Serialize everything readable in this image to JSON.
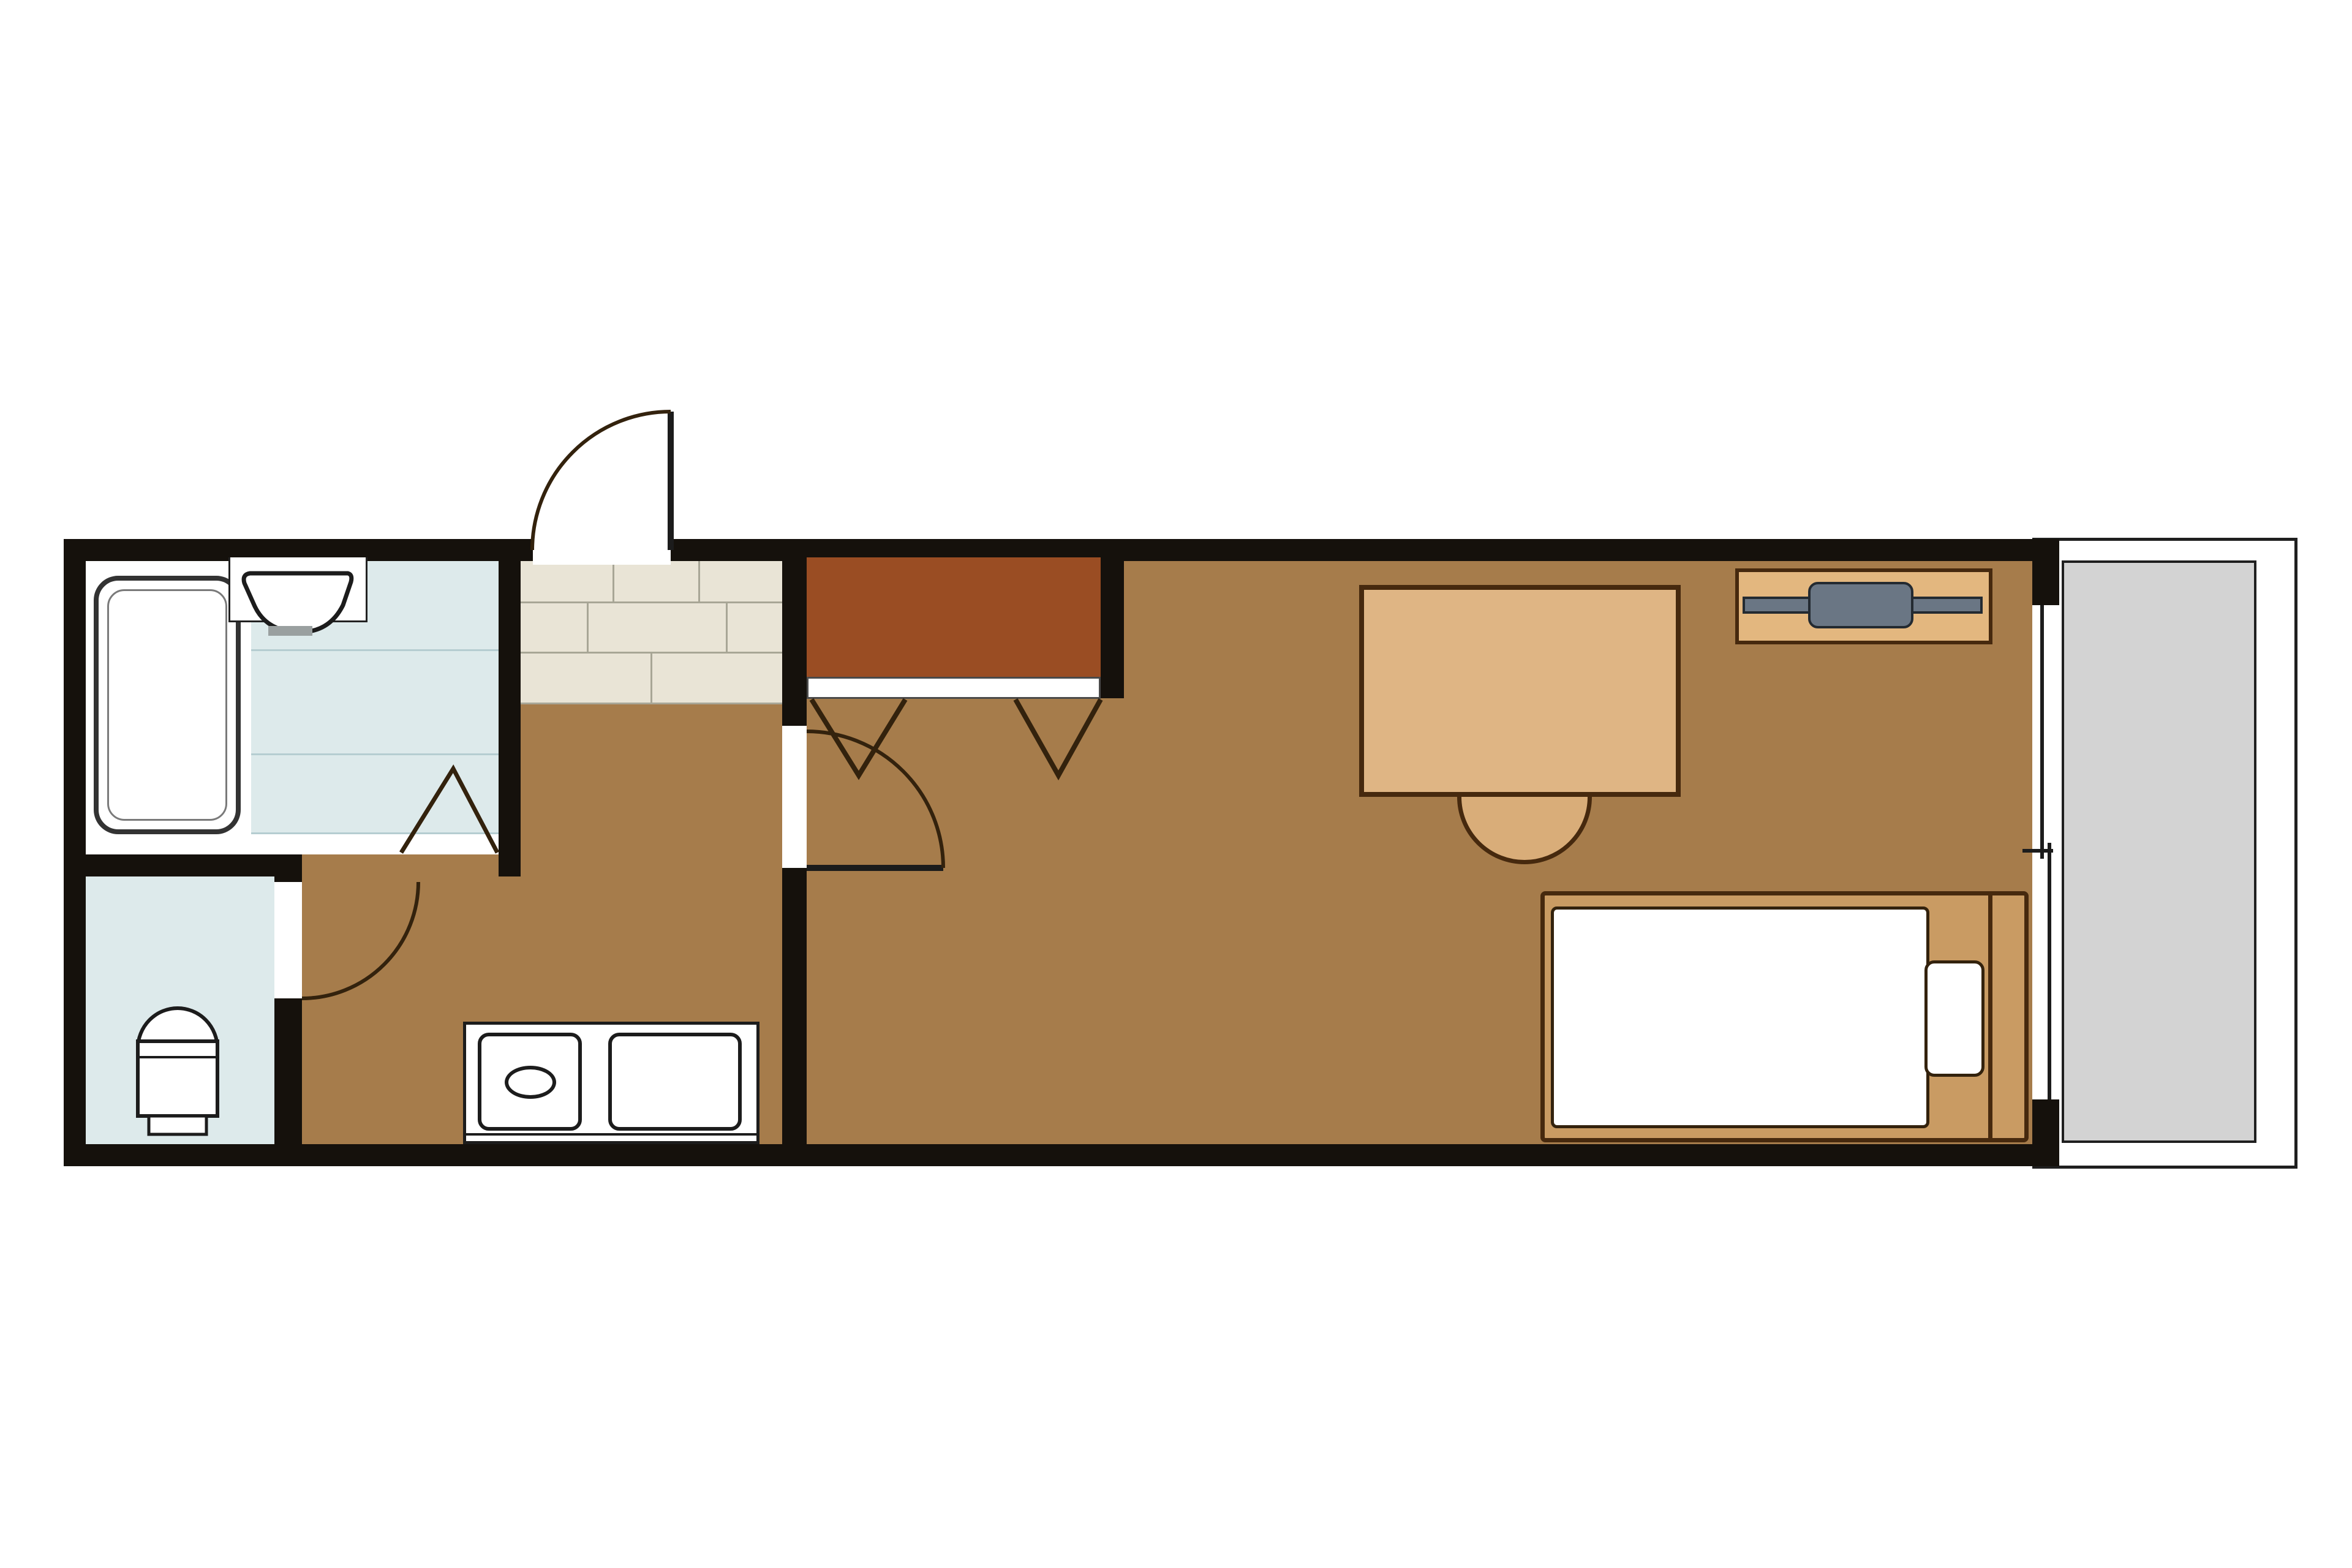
{
  "title": "one-room-apartment-floor-plan",
  "palette": {
    "bg": "#ffffff",
    "wall": "#15110c",
    "floor": "#a67c4b",
    "closet": "#9a4d23",
    "tile": "#ddeaeb",
    "tileLine": "#b5cdd1",
    "genkan": "#e9e4d6",
    "genkanLine": "#a8a696",
    "desk": "#dfb584",
    "chair": "#d9ad79",
    "stand": "#e3b77f",
    "bedframe": "#c99b63",
    "tv": "#6a7684",
    "balcony": "#d3d3d3",
    "outline": "#46290e",
    "symbol": "#33220d",
    "fixture": "#1c1c1c"
  },
  "rooms": [
    {
      "id": "bathroom",
      "floor": "tile-blue",
      "fixtures": [
        "bathtub",
        "washbasin",
        "folding-door"
      ]
    },
    {
      "id": "toilet-room",
      "floor": "tile-blue",
      "fixtures": [
        "toilet",
        "swing-door"
      ]
    },
    {
      "id": "hallway-kitchen",
      "floor": "wood-brown",
      "fixtures": [
        "kitchen-counter",
        "burner",
        "sink",
        "entrance-door",
        "genkan-tiles"
      ]
    },
    {
      "id": "main-room",
      "floor": "wood-brown",
      "fixtures": [
        "closet",
        "desk",
        "chair",
        "tv-stand",
        "tv",
        "bed",
        "mattress",
        "pillow",
        "sliding-window",
        "swing-door"
      ]
    },
    {
      "id": "balcony",
      "floor": "concrete-gray",
      "fixtures": []
    }
  ],
  "fixtures": {
    "bathtub": "white tub with rounded corners, dark outline",
    "washbasin": "fan-shaped basin on white counter",
    "toilet": "tank with arched bowl",
    "kitchen": "counter with one burner and sink",
    "closet": "dark brown closet with white track and two folding-door V marks",
    "bed": "tan frame, white mattress, pillow at right, footboard line",
    "tv": "gray television bar on tan stand",
    "window": "full-height sliding window to balcony"
  }
}
